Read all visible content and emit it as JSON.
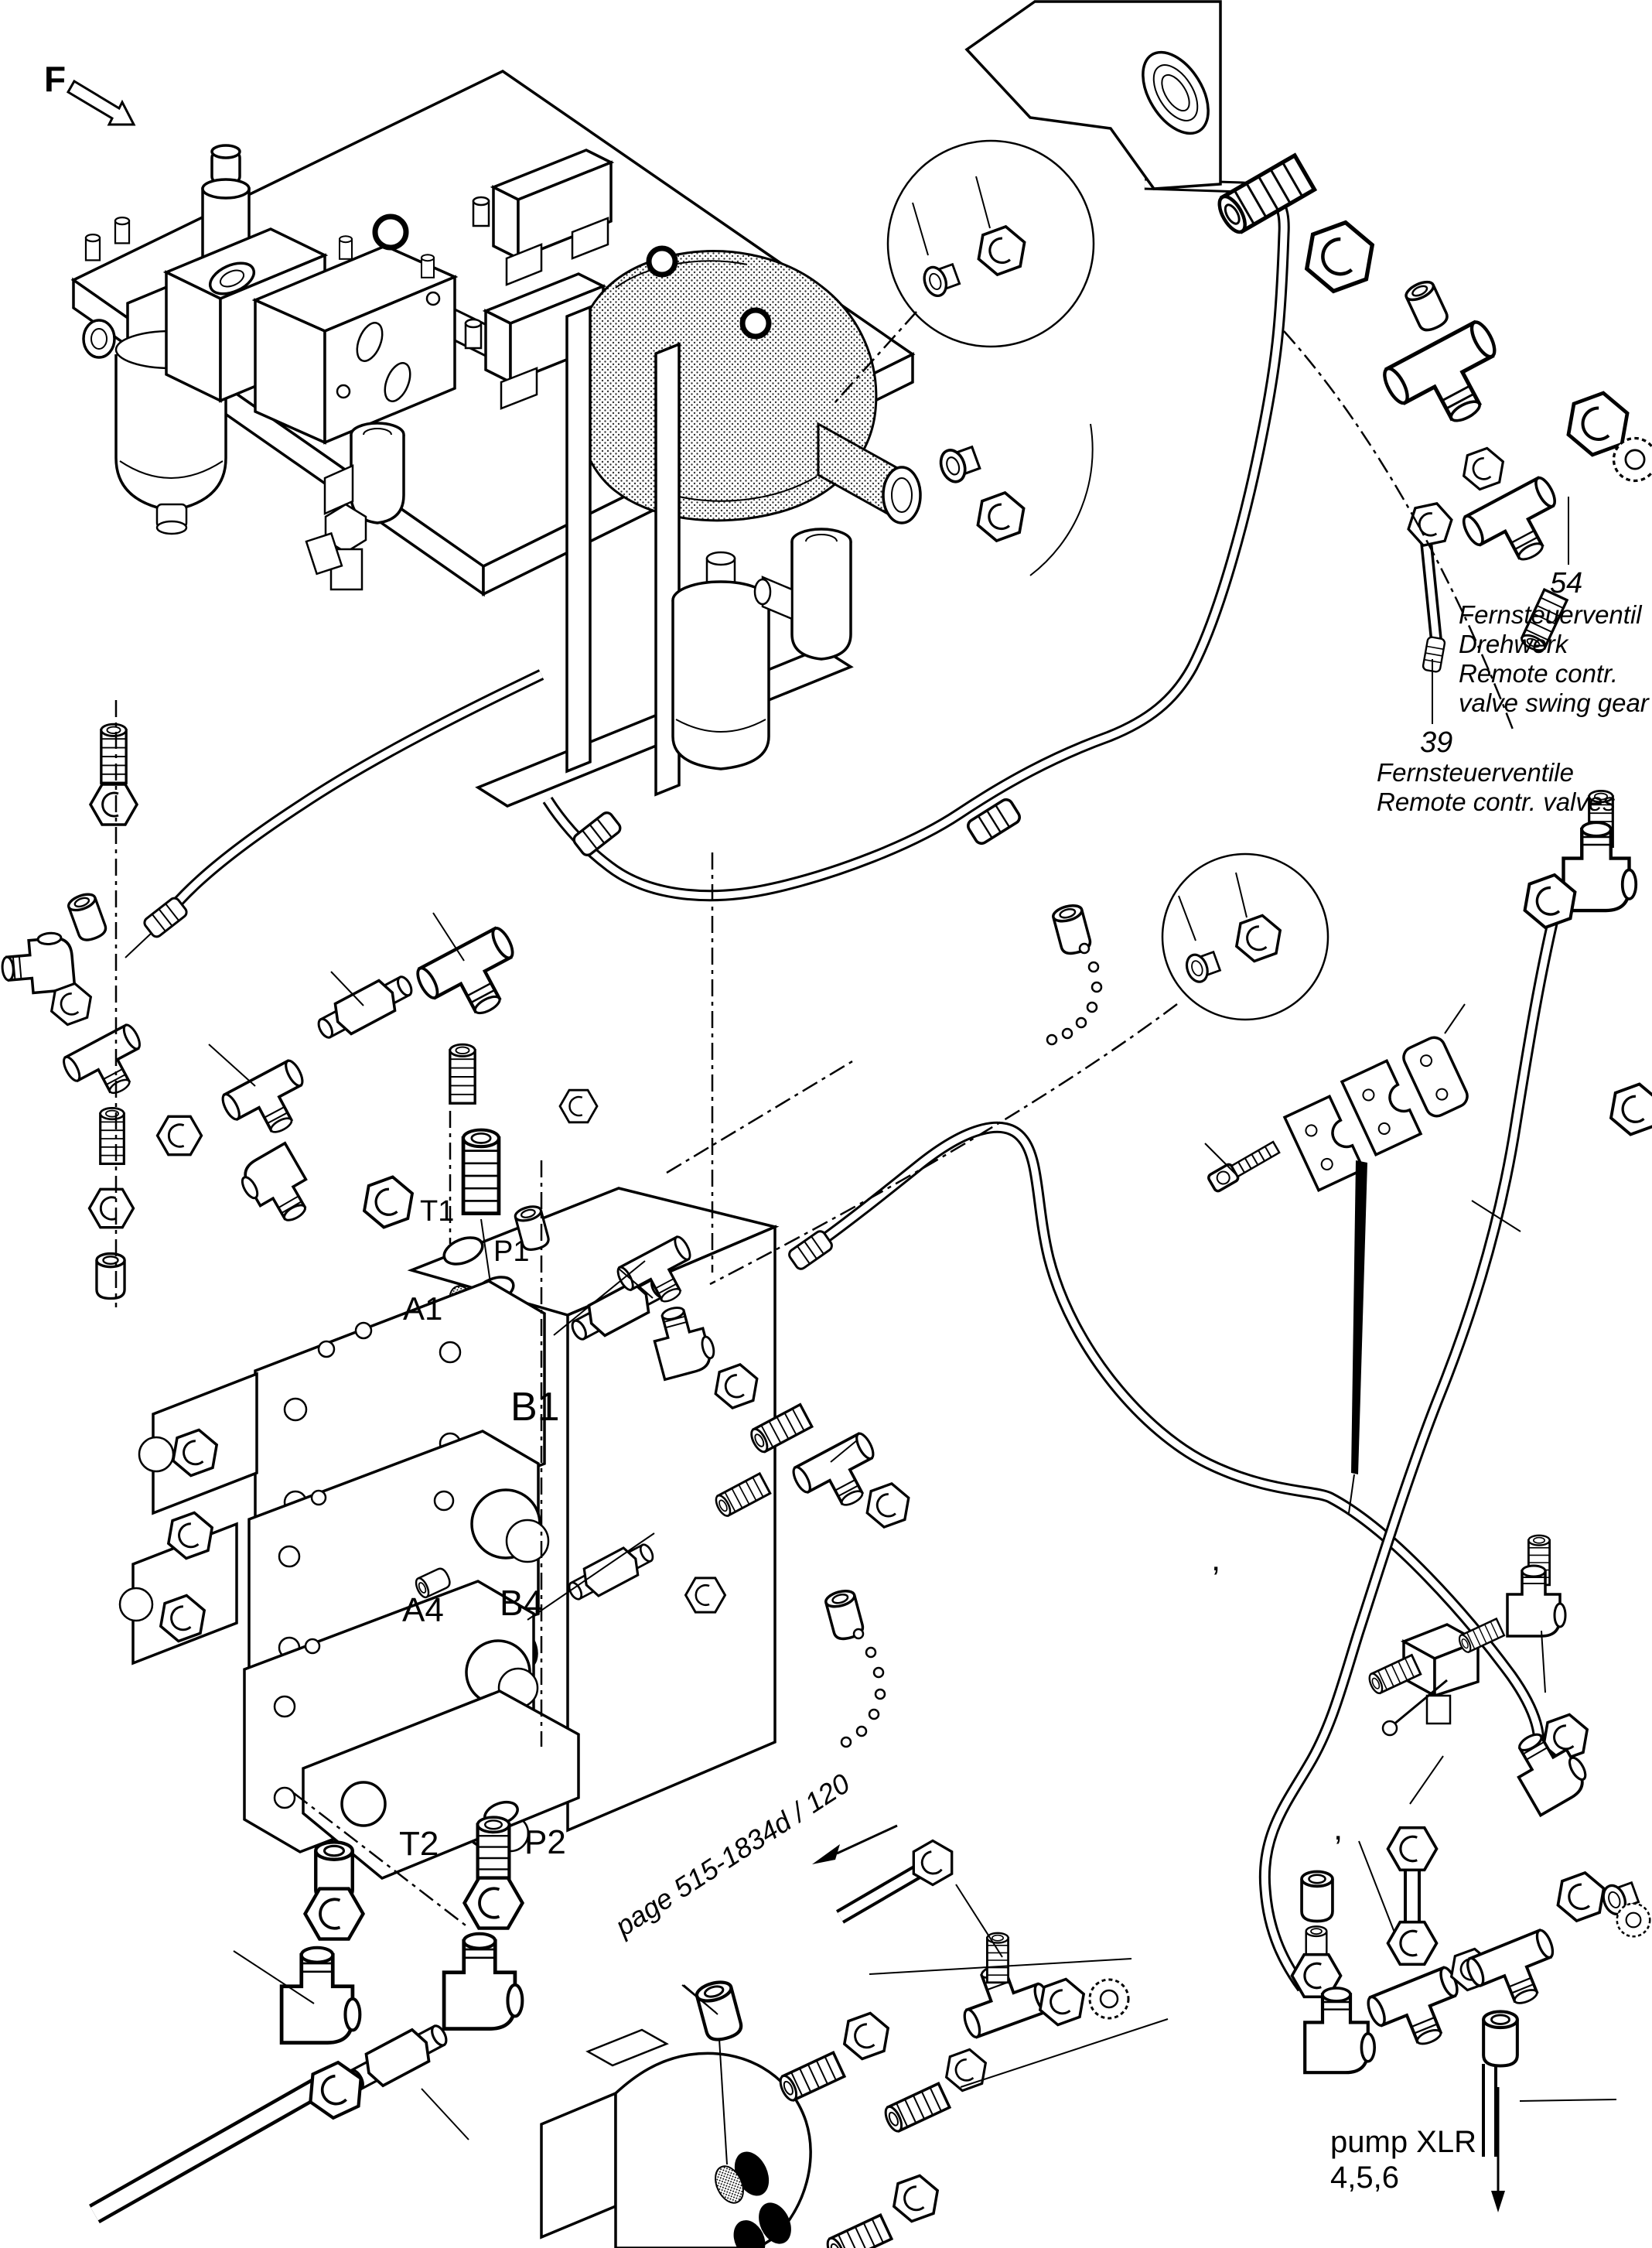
{
  "diagram": {
    "view_label": "F",
    "ports": {
      "t1": "T1",
      "p1": "P1",
      "a1": "A1",
      "b1": "B1",
      "a4": "A4",
      "b4": "B4",
      "t2": "T2",
      "p2": "P2"
    },
    "callout_54": {
      "number": "54",
      "line1": "Fernsteuerventil",
      "line2": "Drehwerk",
      "line3": "Remote contr.",
      "line4": "valve swing gear"
    },
    "callout_39": {
      "number": "39",
      "line1": "Fernsteuerventile",
      "line2": "Remote contr. valves"
    },
    "page_reference": "page 515-1834d / 120",
    "pump_reference": {
      "line1": "pump XLR",
      "line2": "4,5,6"
    },
    "stray_marks": {
      "comma_1": ",",
      "comma_2": ","
    },
    "colors": {
      "line": "#000000",
      "background": "#ffffff",
      "port_filled": "#000000",
      "port_open": "#ffffff"
    }
  }
}
